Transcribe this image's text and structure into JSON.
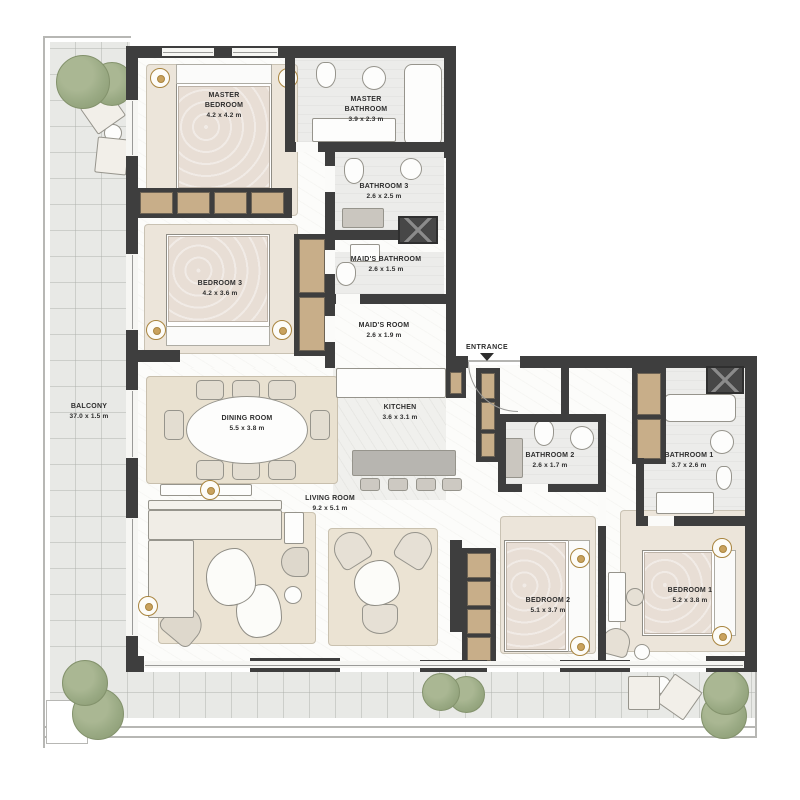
{
  "plan": {
    "entrance": {
      "label": "ENTRANCE"
    },
    "rooms": [
      {
        "name": "MASTER BEDROOM",
        "dims": "4.2 x 4.2 m"
      },
      {
        "name": "MASTER BATHROOM",
        "dims": "3.9 x 2.3 m"
      },
      {
        "name": "BATHROOM 3",
        "dims": "2.6 x 2.5 m"
      },
      {
        "name": "MAID'S BATHROOM",
        "dims": "2.6 x 1.5 m"
      },
      {
        "name": "MAID'S ROOM",
        "dims": "2.6 x 1.9 m"
      },
      {
        "name": "BEDROOM 3",
        "dims": "4.2 x 3.6 m"
      },
      {
        "name": "DINING ROOM",
        "dims": "5.5 x 3.8 m"
      },
      {
        "name": "KITCHEN",
        "dims": "3.6 x 3.1 m"
      },
      {
        "name": "LIVING ROOM",
        "dims": "9.2 x 5.1 m"
      },
      {
        "name": "BALCONY",
        "dims": "37.0 x 1.5 m"
      },
      {
        "name": "BATHROOM 2",
        "dims": "2.6 x 1.7 m"
      },
      {
        "name": "BATHROOM 1",
        "dims": "3.7 x 2.6 m"
      },
      {
        "name": "BEDROOM 2",
        "dims": "5.1 x 3.7 m"
      },
      {
        "name": "BEDROOM 1",
        "dims": "5.2 x 3.8 m"
      }
    ],
    "colors": {
      "wall": "#3e3e3e",
      "wood": "#c8ae89",
      "tree": "#9aaa84",
      "label_text": "#2d2d2d"
    }
  }
}
